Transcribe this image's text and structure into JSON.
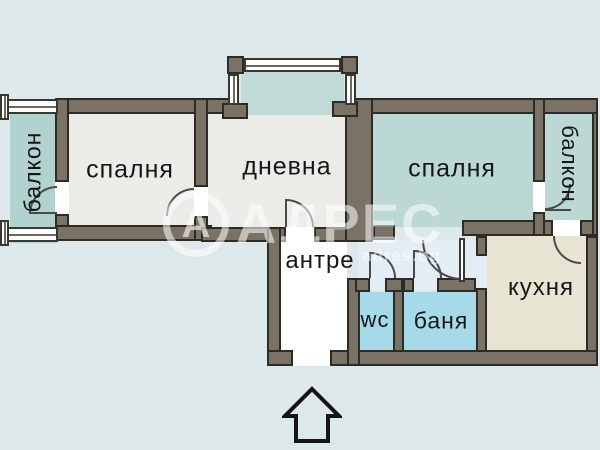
{
  "rooms": {
    "balcony_left": "балкон",
    "bedroom_left": "спалня",
    "living": "дневна",
    "bedroom_right": "спалня",
    "balcony_right": "балкон",
    "hallway": "антре",
    "wc": "wc",
    "bathroom": "баня",
    "kitchen": "кухня"
  },
  "watermark": {
    "logo_letter": "А",
    "brand": "АДРЕС",
    "site": "adres.bg"
  },
  "colors": {
    "background": "#dde8ea",
    "wall": "#7a7265",
    "wall_outline": "#2e2b25",
    "room_gray": "#ebebe7",
    "room_teal": "#bcd8d4",
    "balcony_teal": "#b2d2cf",
    "room_blue": "#a7dae9",
    "room_beige": "#e8e4d2",
    "corridor_blue": "#e2eef4",
    "hallway_white": "#ffffff"
  }
}
